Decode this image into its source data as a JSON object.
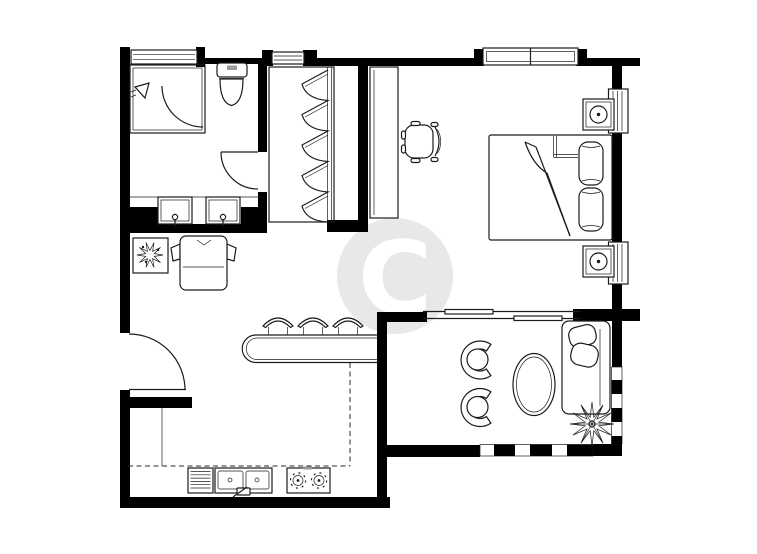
{
  "document": {
    "type": "residential-floor-plan",
    "style": "black-and-white line drawing",
    "width_px": 757,
    "height_px": 554
  },
  "watermark": {
    "letter": "C",
    "disc_color": "#e8e8e8",
    "letter_color": "#ffffff"
  },
  "colors": {
    "background": "#ffffff",
    "walls": "#000000",
    "lines": "#1c1c1c"
  },
  "rooms": [
    {
      "id": "bathroom",
      "position": "top-left",
      "furniture": [
        "shower-enclosure",
        "shower-head",
        "shower-door",
        "toilet",
        "vanity-sink",
        "vanity-sink",
        "swing-door"
      ]
    },
    {
      "id": "walk-in-closet",
      "position": "top-middle",
      "furniture": [
        "wardrobe-hanging-rail-with-clothes"
      ]
    },
    {
      "id": "bedroom",
      "position": "top-right",
      "furniture": [
        "desk",
        "desk-chair",
        "double-bed",
        "pillow",
        "pillow",
        "nightstand-lamp",
        "nightstand-lamp"
      ]
    },
    {
      "id": "living-dining",
      "position": "middle-left",
      "furniture": [
        "framed-plant",
        "armchair",
        "bar-counter",
        "bar-stool",
        "bar-stool",
        "bar-stool",
        "entry-door"
      ]
    },
    {
      "id": "kitchen",
      "position": "bottom-left",
      "furniture": [
        "dish-rack",
        "double-sink-with-faucet",
        "cooktop-two-burners",
        "counter-dashed-outline"
      ]
    },
    {
      "id": "balcony",
      "position": "bottom-right",
      "furniture": [
        "lounge-chair",
        "lounge-chair",
        "oval-table",
        "sofa-two-cushions",
        "plant",
        "railing-checkered",
        "sliding-door"
      ]
    }
  ],
  "openings": {
    "windows_top": 3,
    "windows_right": 2,
    "swing_doors": 3,
    "sliding_doors": 1
  }
}
